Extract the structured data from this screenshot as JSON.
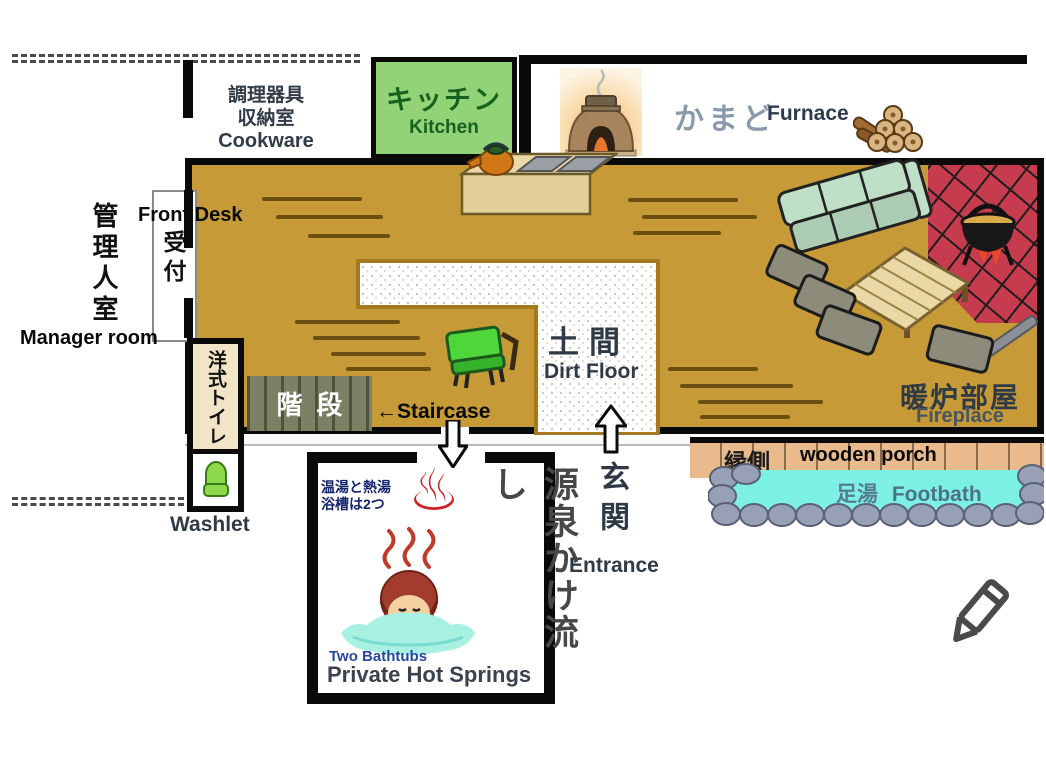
{
  "labels": {
    "cookware": {
      "jp1": "調理器具",
      "jp2": "収納室",
      "en": "Cookware"
    },
    "kitchen": {
      "jp": "キッチン",
      "en": "Kitchen"
    },
    "furnace": {
      "jp": "かまど",
      "en": "Furnace"
    },
    "front_desk": {
      "en": "Front Desk",
      "reception_jp": "受付"
    },
    "manager_room": {
      "jp": "管理人室",
      "en": "Manager room"
    },
    "toilet": {
      "jp": "洋式トイレ",
      "en": "Washlet"
    },
    "staircase": {
      "jp": "階段",
      "en": "←Staircase"
    },
    "dirt_floor": {
      "jp": "土間",
      "en": "Dirt Floor"
    },
    "entrance": {
      "jp": "玄関",
      "en": "Entrance"
    },
    "fireplace_room": {
      "jp": "暖炉部屋",
      "en": "Fireplace"
    },
    "porch": {
      "jp": "縁側",
      "en": "wooden porch"
    },
    "footbath": {
      "jp": "足湯",
      "en": "Footbath"
    },
    "hot_springs": {
      "note_line1": "温湯と熱湯",
      "note_line2": "浴槽は2つ",
      "jp": "源泉かけ流し",
      "en_sub": "Two Bathtubs",
      "en": "Private Hot Springs"
    }
  },
  "icons": {
    "onsen_symbol": "♨",
    "names": [
      "furnace-icon",
      "firewood-icon",
      "teapot-icon",
      "stove-counter-icon",
      "bench-icon",
      "sofa-icon",
      "low-table-icon",
      "floor-cushion-icon",
      "hanging-pot-icon",
      "fire-poker-icon",
      "toilet-icon",
      "bathing-person-icon",
      "footbath-stones-icon",
      "entrance-arrow-icon",
      "staircase-arrow-icon",
      "pencil-icon"
    ]
  },
  "colors": {
    "floor_tan": "#c69a36",
    "kitchen_green": "#92d377",
    "rug_red": "#c63b4e",
    "water_cyan": "#7df0e4",
    "porch_tan": "#e9ba8c",
    "toilet_cream": "#f2e4c6",
    "stair_olive": "#7c8163",
    "onsen_red": "#cc2222",
    "wall_black": "#0a0a0a",
    "dirt_border_brown": "#a5791f"
  }
}
